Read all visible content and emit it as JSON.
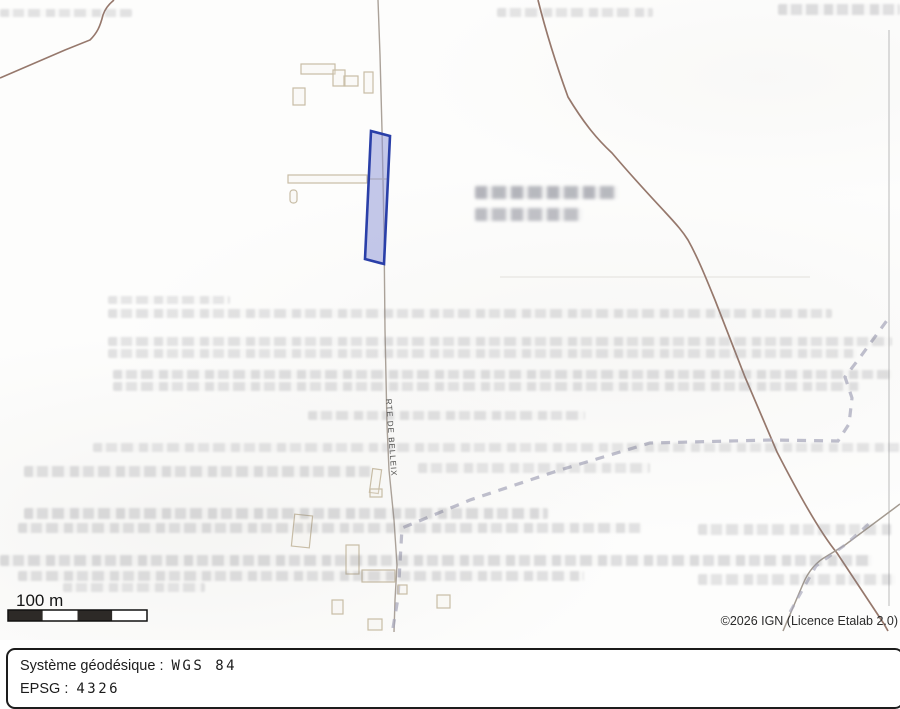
{
  "map": {
    "road_label": "RTE DE BELLEIX",
    "scale_bar": {
      "label": "100 m"
    },
    "attribution": "©2026 IGN (Licence Etalab 2.0)",
    "parcel": {
      "fill": "#8e96d6",
      "stroke": "#2a3fa8"
    }
  },
  "footer": {
    "lines": [
      {
        "label": "Système géodésique :",
        "value": "WGS 84"
      },
      {
        "label": "EPSG :",
        "value": "4326"
      }
    ]
  },
  "colors": {
    "road_brown": "#96786c",
    "road_gray": "#a39a90",
    "road_light": "#aba299",
    "path_dash": "#a6a6ba",
    "boundary": "#c0c0c0",
    "building_outline": "#c8bda6",
    "scale_dark": "#2d2a27",
    "text_dark": "#2b2b2b"
  }
}
